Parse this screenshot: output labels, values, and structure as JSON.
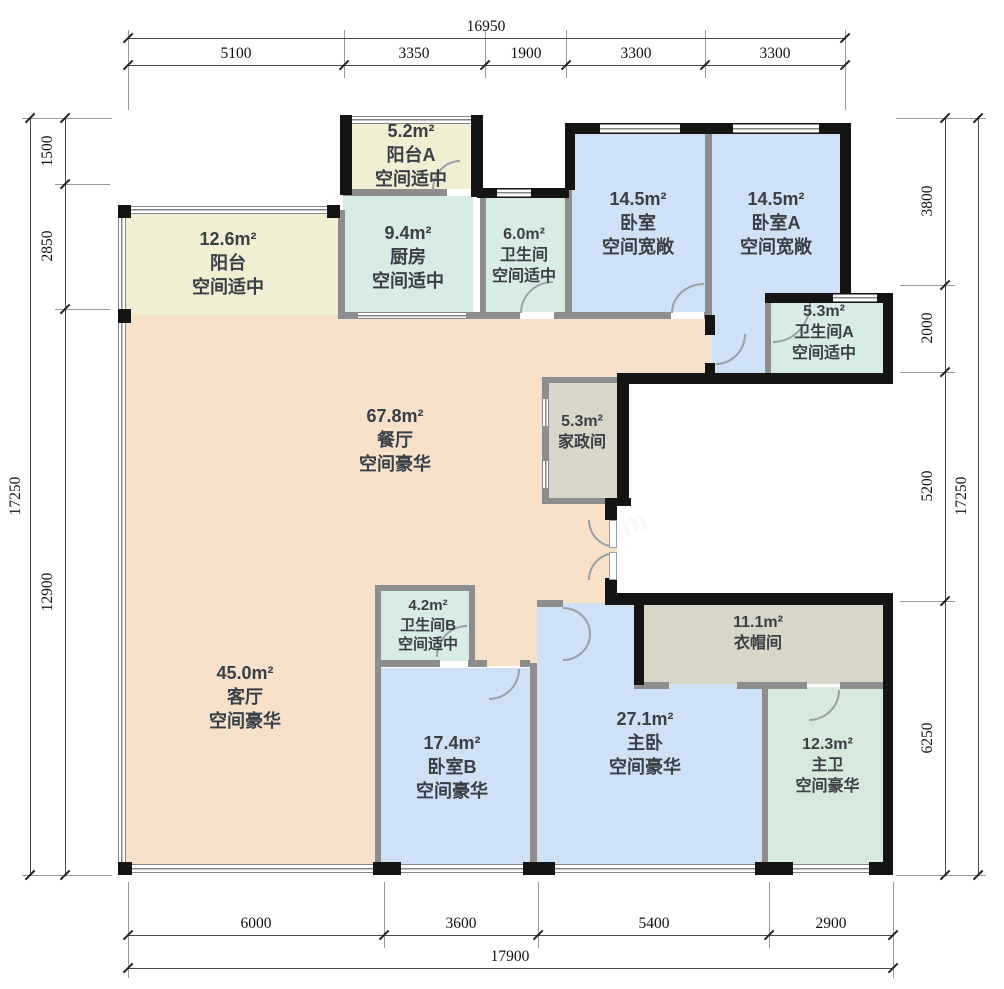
{
  "dims": {
    "top": {
      "total": "16950",
      "segments": [
        "5100",
        "3350",
        "1900",
        "3300",
        "3300"
      ]
    },
    "bottom": {
      "total": "17900",
      "segments": [
        "6000",
        "3600",
        "5400",
        "2900"
      ]
    },
    "left": {
      "total": "17250",
      "segments": [
        "1500",
        "2850",
        "12900"
      ]
    },
    "right": {
      "total": "17250",
      "segments": [
        "3800",
        "2000",
        "5200",
        "6250"
      ]
    }
  },
  "rooms": {
    "balcony": {
      "area": "12.6m²",
      "name": "阳台",
      "desc": "空间适中"
    },
    "balcony_a": {
      "area": "5.2m²",
      "name": "阳台A",
      "desc": "空间适中"
    },
    "kitchen": {
      "area": "9.4m²",
      "name": "厨房",
      "desc": "空间适中"
    },
    "bathroom": {
      "area": "6.0m²",
      "name": "卫生间",
      "desc": "空间适中"
    },
    "bedroom": {
      "area": "14.5m²",
      "name": "卧室",
      "desc": "空间宽敞"
    },
    "bedroom_a": {
      "area": "14.5m²",
      "name": "卧室A",
      "desc": "空间宽敞"
    },
    "bathroom_a": {
      "area": "5.3m²",
      "name": "卫生间A",
      "desc": "空间适中"
    },
    "housekeeping": {
      "area": "5.3m²",
      "name": "家政间"
    },
    "dining": {
      "area": "67.8m²",
      "name": "餐厅",
      "desc": "空间豪华"
    },
    "living": {
      "area": "45.0m²",
      "name": "客厅",
      "desc": "空间豪华"
    },
    "bathroom_b": {
      "area": "4.2m²",
      "name": "卫生间B",
      "desc": "空间适中"
    },
    "bedroom_b": {
      "area": "17.4m²",
      "name": "卧室B",
      "desc": "空间豪华"
    },
    "master_bedroom": {
      "area": "27.1m²",
      "name": "主卧",
      "desc": "空间豪华"
    },
    "cloakroom": {
      "area": "11.1m²",
      "name": "衣帽间"
    },
    "master_bathroom": {
      "area": "12.3m²",
      "name": "主卫",
      "desc": "空间豪华"
    }
  },
  "colors": {
    "living_dining": "#f7e1ca",
    "bedroom": "#cfe1f6",
    "bath_kitchen": "#d8ece6",
    "master_bath": "#d5e9dc",
    "balcony": "#f2eed3",
    "utility": "#d8d6c6",
    "wall": "#141414"
  },
  "watermark": "房天下 fang.com"
}
